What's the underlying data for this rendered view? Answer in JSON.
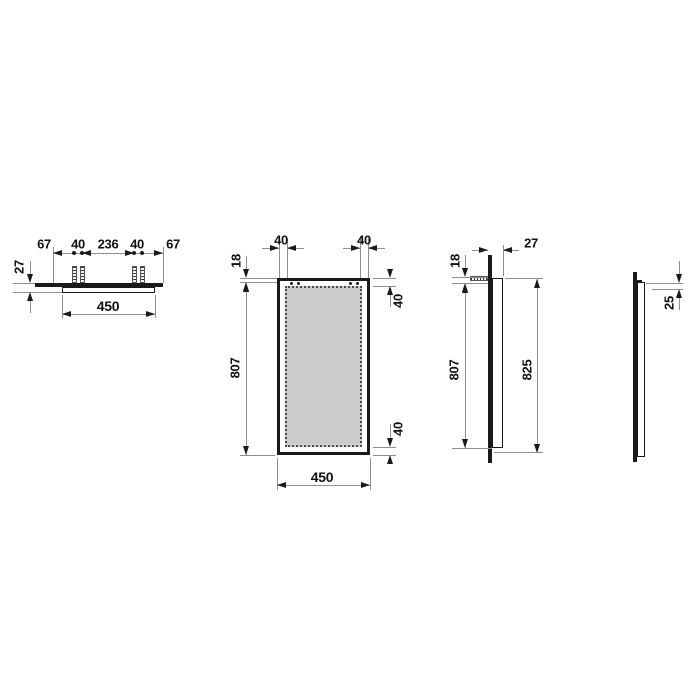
{
  "drawing": {
    "type": "technical-dimension-drawing",
    "background_color": "#ffffff",
    "object_line_color": "#1a1a1a",
    "thin_line_color": "#8f8f8f",
    "mirror_face_fill": "#cbcbcb",
    "views": {
      "top_view": {
        "dims": {
          "edge_to_anchor_left": "67",
          "anchor_pair_gap_left": "40",
          "anchor_center_span": "236",
          "anchor_pair_gap_right": "40",
          "edge_to_anchor_right": "67",
          "depth": "27",
          "width": "450"
        }
      },
      "front_view": {
        "dims": {
          "bracket_inset_left": "40",
          "bracket_inset_right": "40",
          "top_to_anchor": "18",
          "anchor_to_bottom": "807",
          "light_inset_top": "40",
          "light_inset_bottom": "40",
          "width": "450"
        }
      },
      "side_view": {
        "dims": {
          "depth": "27",
          "top_to_anchor": "18",
          "anchor_to_bottom": "807",
          "overall_height": "825"
        }
      },
      "profile_view": {
        "dims": {
          "frame_inset": "25"
        }
      }
    }
  }
}
